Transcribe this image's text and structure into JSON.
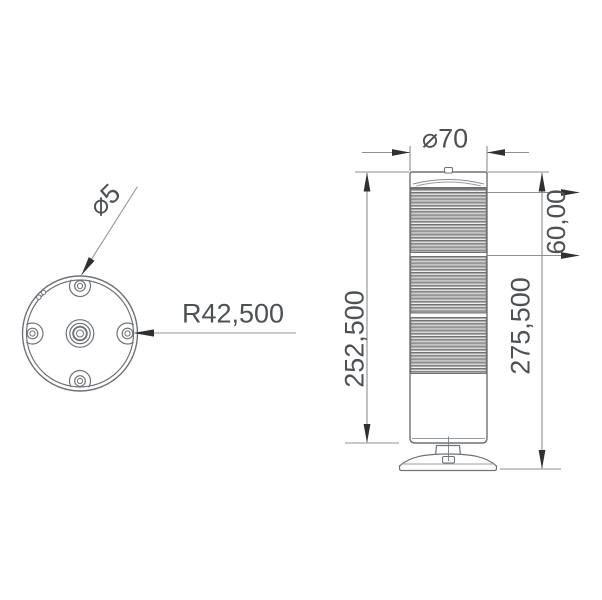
{
  "labels": {
    "hole_diameter": "⌀5",
    "bolt_circle_radius": "R42,500",
    "tower_diameter": "⌀70",
    "module_height": "60,00",
    "body_height": "252,500",
    "total_height": "275,500"
  },
  "colors": {
    "dimension_line": "#8b8f91",
    "object_line": "#6e7276",
    "arrow": "#2e3133",
    "text": "#4d5154",
    "rib_dark": "#6e6e6e",
    "rib_mid": "#a9a9a9",
    "rib_light": "#f0f0f0"
  }
}
